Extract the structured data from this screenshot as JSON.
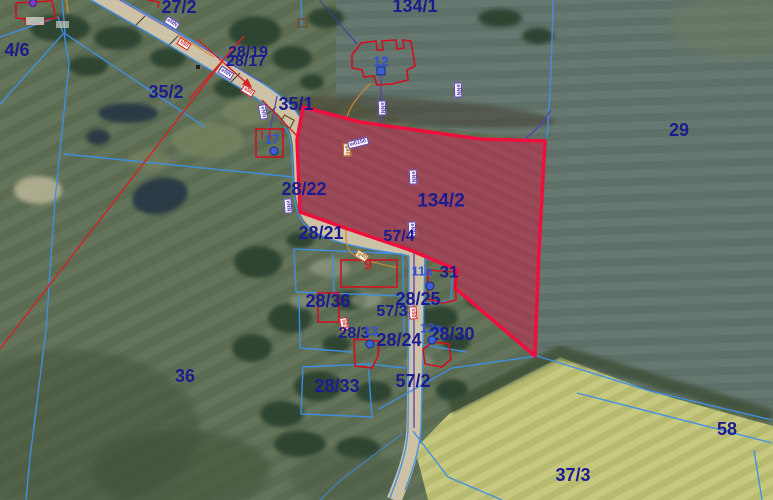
{
  "map": {
    "description": "Aerial cadastral parcel map with highlighted parcel",
    "highlighted_parcel": "134/2",
    "colors": {
      "parcel_label": "#1c1c8f",
      "address_label": "#2f52d9",
      "building_label": "#c82222",
      "boundary_blue": "#3f8fe8",
      "highlight_red": "#ef0f3c",
      "highlight_fill": "#e0286a",
      "utility_purple": "#5b3fae",
      "utility_orange": "#cc8a2a"
    },
    "labels": [
      {
        "t": "4/6",
        "x": 17,
        "y": 50,
        "c": "p",
        "s": 18
      },
      {
        "t": "27/2",
        "x": 179,
        "y": 7,
        "c": "p",
        "s": 18
      },
      {
        "t": "134/1",
        "x": 415,
        "y": 6,
        "c": "p",
        "s": 18
      },
      {
        "t": "28/19",
        "x": 248,
        "y": 53,
        "c": "p",
        "s": 16
      },
      {
        "t": "28/17",
        "x": 246,
        "y": 62,
        "c": "p",
        "s": 16
      },
      {
        "t": "12",
        "x": 381,
        "y": 61,
        "c": "a",
        "s": 14
      },
      {
        "t": "35/2",
        "x": 166,
        "y": 92,
        "c": "p",
        "s": 18
      },
      {
        "t": "35/1",
        "x": 296,
        "y": 104,
        "c": "p",
        "s": 18
      },
      {
        "t": "17",
        "x": 272,
        "y": 139,
        "c": "a",
        "s": 13
      },
      {
        "t": "29",
        "x": 679,
        "y": 130,
        "c": "p",
        "s": 18
      },
      {
        "t": "28/22",
        "x": 304,
        "y": 189,
        "c": "p",
        "s": 18
      },
      {
        "t": "134/2",
        "x": 441,
        "y": 201,
        "c": "p",
        "s": 19
      },
      {
        "t": "28/21",
        "x": 321,
        "y": 233,
        "c": "p",
        "s": 18
      },
      {
        "t": "57/4",
        "x": 399,
        "y": 237,
        "c": "p",
        "s": 16
      },
      {
        "t": "9",
        "x": 368,
        "y": 265,
        "c": "b",
        "s": 15
      },
      {
        "t": "11a",
        "x": 422,
        "y": 271,
        "c": "a",
        "s": 13
      },
      {
        "t": "31",
        "x": 449,
        "y": 272,
        "c": "p",
        "s": 17
      },
      {
        "t": "28/36",
        "x": 328,
        "y": 301,
        "c": "p",
        "s": 18
      },
      {
        "t": "28/25",
        "x": 418,
        "y": 299,
        "c": "p",
        "s": 18
      },
      {
        "t": "57/3",
        "x": 392,
        "y": 312,
        "c": "p",
        "s": 16
      },
      {
        "t": "28/3",
        "x": 354,
        "y": 334,
        "c": "p",
        "s": 16
      },
      {
        "t": "13",
        "x": 371,
        "y": 331,
        "c": "a",
        "s": 13
      },
      {
        "t": "28/24",
        "x": 399,
        "y": 340,
        "c": "p",
        "s": 18
      },
      {
        "t": "13a",
        "x": 431,
        "y": 328,
        "c": "a",
        "s": 13
      },
      {
        "t": "28/30",
        "x": 452,
        "y": 334,
        "c": "p",
        "s": 18
      },
      {
        "t": "36",
        "x": 185,
        "y": 376,
        "c": "p",
        "s": 18
      },
      {
        "t": "28/33",
        "x": 337,
        "y": 386,
        "c": "p",
        "s": 18
      },
      {
        "t": "57/2",
        "x": 413,
        "y": 381,
        "c": "p",
        "s": 18
      },
      {
        "t": "58",
        "x": 727,
        "y": 429,
        "c": "p",
        "s": 18
      },
      {
        "t": "37/3",
        "x": 573,
        "y": 475,
        "c": "p",
        "s": 18
      }
    ],
    "address_dots": [
      {
        "x": 381,
        "y": 71,
        "shape": "square",
        "color": "blue"
      },
      {
        "x": 274,
        "y": 151,
        "shape": "round",
        "color": "blue"
      },
      {
        "x": 430,
        "y": 286,
        "shape": "round",
        "color": "blue"
      },
      {
        "x": 370,
        "y": 344,
        "shape": "round",
        "color": "blue"
      },
      {
        "x": 432,
        "y": 340,
        "shape": "round",
        "color": "blue"
      },
      {
        "x": 33,
        "y": 3,
        "shape": "round",
        "color": "purple"
      }
    ],
    "utility_badges": [
      {
        "t": "eNN",
        "x": 172,
        "y": 23,
        "r": 32,
        "c": "purple"
      },
      {
        "t": "s50",
        "x": 184,
        "y": 44,
        "r": 32,
        "c": "red"
      },
      {
        "t": "eNN",
        "x": 226,
        "y": 73,
        "r": 32,
        "c": "purple"
      },
      {
        "t": "s50",
        "x": 248,
        "y": 91,
        "r": 32,
        "c": "red"
      },
      {
        "t": "eNN",
        "x": 263,
        "y": 112,
        "r": 80,
        "c": "purple"
      },
      {
        "t": "eNN",
        "x": 288,
        "y": 206,
        "r": 85,
        "c": "purple"
      },
      {
        "t": "eNN",
        "x": 382,
        "y": 108,
        "r": 88,
        "c": "purple"
      },
      {
        "t": "g40",
        "x": 347,
        "y": 150,
        "r": 88,
        "c": "orange"
      },
      {
        "t": "w0150",
        "x": 358,
        "y": 143,
        "r": -14,
        "c": "purple"
      },
      {
        "t": "eNN",
        "x": 413,
        "y": 177,
        "r": 88,
        "c": "purple"
      },
      {
        "t": "eNN",
        "x": 412,
        "y": 229,
        "r": 88,
        "c": "purple"
      },
      {
        "t": "eNN",
        "x": 458,
        "y": 90,
        "r": 88,
        "c": "purple"
      },
      {
        "t": "g40",
        "x": 362,
        "y": 256,
        "r": 30,
        "c": "orange"
      },
      {
        "t": "s63",
        "x": 344,
        "y": 324,
        "r": 80,
        "c": "red"
      },
      {
        "t": "s50",
        "x": 413,
        "y": 313,
        "r": 85,
        "c": "red"
      }
    ]
  }
}
